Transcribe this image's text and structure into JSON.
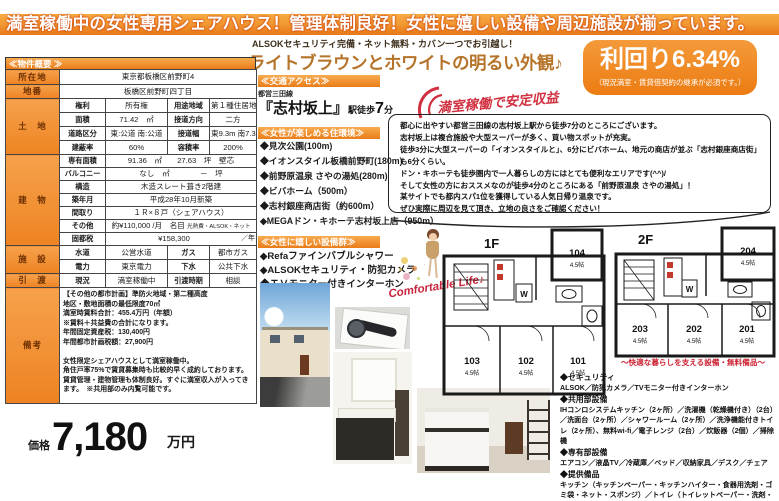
{
  "banner": {
    "text": "満室稼働中の女性専用シェアハウス！管理体制良好！女性に嬉しい設備や周辺施設が揃っています。"
  },
  "intro": {
    "alsok_line": "ALSOKセキュリティ完備・ネット無料・カバン一つでお引越し！",
    "headline": "ライトブラウンとホワイトの明るい外観♪"
  },
  "yield_badge": {
    "value": "利回り6.34%",
    "note": "（現況満室・賃貸借契約の継承が必須です。）"
  },
  "overview": {
    "header": "≪物件概要 ≫",
    "rows": {
      "address": {
        "label": "所在地",
        "value": "東京都板橋区前野町4"
      },
      "lot": {
        "label": "地番",
        "value": "板橋区前野町四丁目"
      },
      "land_label": "土　地",
      "land1": {
        "l1": "権利",
        "v1": "所有権",
        "l2": "用途地域",
        "v2": "第１種住居地域"
      },
      "land2": {
        "l1": "面積",
        "v1": "71.42　㎡",
        "l2": "接道方向",
        "v2": "二方"
      },
      "land3": {
        "l1": "道路区分",
        "v1": "東:公道 南:公道",
        "l2": "接道幅",
        "v2": "東9.3m 南7.39m"
      },
      "land4": {
        "l1": "建蔽率",
        "v1": "60%",
        "l2": "容積率",
        "v2": "200%"
      },
      "building_label": "建　物",
      "b1": {
        "l": "専有面積",
        "v": "91.36　㎡　　27.63　坪　壁芯"
      },
      "b2": {
        "l": "バルコニー",
        "v": "なし　㎡　　　　－　坪"
      },
      "b3": {
        "l": "構造",
        "v": "木造スレート葺き2階建"
      },
      "b4": {
        "l": "築年月",
        "v": "平成28年10月新築"
      },
      "b5": {
        "l": "間取り",
        "v": "１Ｒ×８戸（シェアハウス）"
      },
      "b6": {
        "l": "その他",
        "v": "約¥110,000 /月　名目",
        "note": "光熱費・ALSOK・ネット"
      },
      "b7": {
        "l": "固都税",
        "v": "¥158,300",
        "unit": "／年"
      },
      "facility_label": "施　設",
      "f1": {
        "l1": "水道",
        "v1": "公営水道",
        "l2": "ガス",
        "v2": "都市ガス"
      },
      "f2": {
        "l1": "電力",
        "v1": "東京電力",
        "l2": "下水",
        "v2": "公共下水"
      },
      "handover_label": "引　渡",
      "h1": {
        "l1": "現況",
        "v1": "満室稼働中",
        "l2": "引渡時期",
        "v2": "相談"
      },
      "remarks_label": "備考",
      "remarks": "【その他の都市計画】準防火地域・第二種高度\n地区・敷地面積の最低限度70㎡\n満室時賃料合計：455.4万円（年額）\n※賃料＋共益費の合計になります。\n年間固定資産税：130,400円\n年間都市計画税額：27,900円\n\n女性限定シェアハウスとして満室稼働中。\n角住戸率75%で賃貸募集時も比較的早く成約しております。\n賃貸管理・建物管理も体制良好。すぐに満室収入が入ってきます。　※共用部のみ内覧可能です。"
    }
  },
  "access": {
    "header": "≪交通アクセス≫",
    "line": "都営三田線",
    "station": "『志村坂上』",
    "walk_prefix": "駅徒歩",
    "walk_num": "7",
    "walk_suffix": "分"
  },
  "stamp": {
    "text": "満室稼働で安定収益"
  },
  "environment": {
    "header": "≪女性が楽しめる住環境≫",
    "items": [
      "◆見次公園(100m)",
      "◆イオンスタイル板橋前野町(180m)",
      "◆前野原温泉 さやの湯処(280m)",
      "◆ビバホーム（500m）",
      "◆志村銀座商店街（約600m）",
      "◆MEGAドン・キホーテ志村坂上店（950m）"
    ]
  },
  "amenities": {
    "header": "≪女性に嬉しい設備群≫",
    "items": [
      "◆Refaファインバブルシャワー",
      "◆ALSOKセキュリティ・防犯カメラ",
      "◆ＴＶモニター付きインターホン"
    ]
  },
  "pitch": {
    "text": "都心に出やすい都営三田線の志村坂上駅から徒歩7分のところにございます。\n志村坂上は複合施設や大型スーパーが多く、買い物スポットが充実。\n徒歩3分に大型スーパーの「イオンスタイルと」、6分にビバホーム、地元の商店が並ぶ「志村銀座商店街」も6分くらい。\nドン・キホーテも徒歩圏内で一人暮らしの方にはとても便利なエリアです(^^)/\nそして女性の方におススメなのが徒歩4分のところにある「前野原温泉 さやの湯処」！\n某サイトでも都内スパ1位を獲得している人気日帰り温泉です。\nぜひ実際に周辺を見て頂き、立地の良さをご確認ください！"
  },
  "comfortable": {
    "text": "Comfortable Life♪"
  },
  "floorplans": {
    "floor1_label": "1F",
    "floor2_label": "2F",
    "washer_label": "W",
    "caption": "〜快適な暮らしを支える設備・無料備品〜",
    "rooms_1f": [
      {
        "no": "104",
        "size": "4.5帖"
      },
      {
        "no": "103",
        "size": "4.5帖"
      },
      {
        "no": "102",
        "size": "4.5帖"
      },
      {
        "no": "101",
        "size": "4.5帖"
      }
    ],
    "rooms_2f": [
      {
        "no": "204",
        "size": "4.5帖"
      },
      {
        "no": "203",
        "size": "4.5帖"
      },
      {
        "no": "202",
        "size": "4.5帖"
      },
      {
        "no": "201",
        "size": "4.5帖"
      }
    ]
  },
  "equipment": {
    "sections": [
      {
        "title": "◆セキュリティ",
        "body": "ALSOK／防犯カメラ／TVモニター付きインターホン"
      },
      {
        "title": "◆共用部設備",
        "body": "IHコンロシステムキッチン（2ヶ所）／洗濯機（乾燥機付き）（2台）／洗面台（2ヶ所）／シャワールーム（2ヶ所）／洗浄機能付きトイレ（2ヶ所）、無料wi-fi／電子レンジ（2台）／炊飯器（2個）／掃除機"
      },
      {
        "title": "◆専有部設備",
        "body": "エアコン／液晶TV／冷蔵庫／ベッド／収納家具／デスク／チェア"
      },
      {
        "title": "◆提供備品",
        "body": "キッチン（キッチンペーパー・キッチンハイター・食器用洗剤・ゴミ袋・ネット・スポンジ）／トイレ（トイレットペーパー・洗剤・サニタリーボックス）／洗面（ハンドソープ）・掃除機"
      }
    ]
  },
  "price": {
    "label": "価格",
    "value": "7,180",
    "unit": "万円"
  },
  "colors": {
    "accent_orange": "#ee7d15",
    "accent_red": "#cc2233"
  }
}
